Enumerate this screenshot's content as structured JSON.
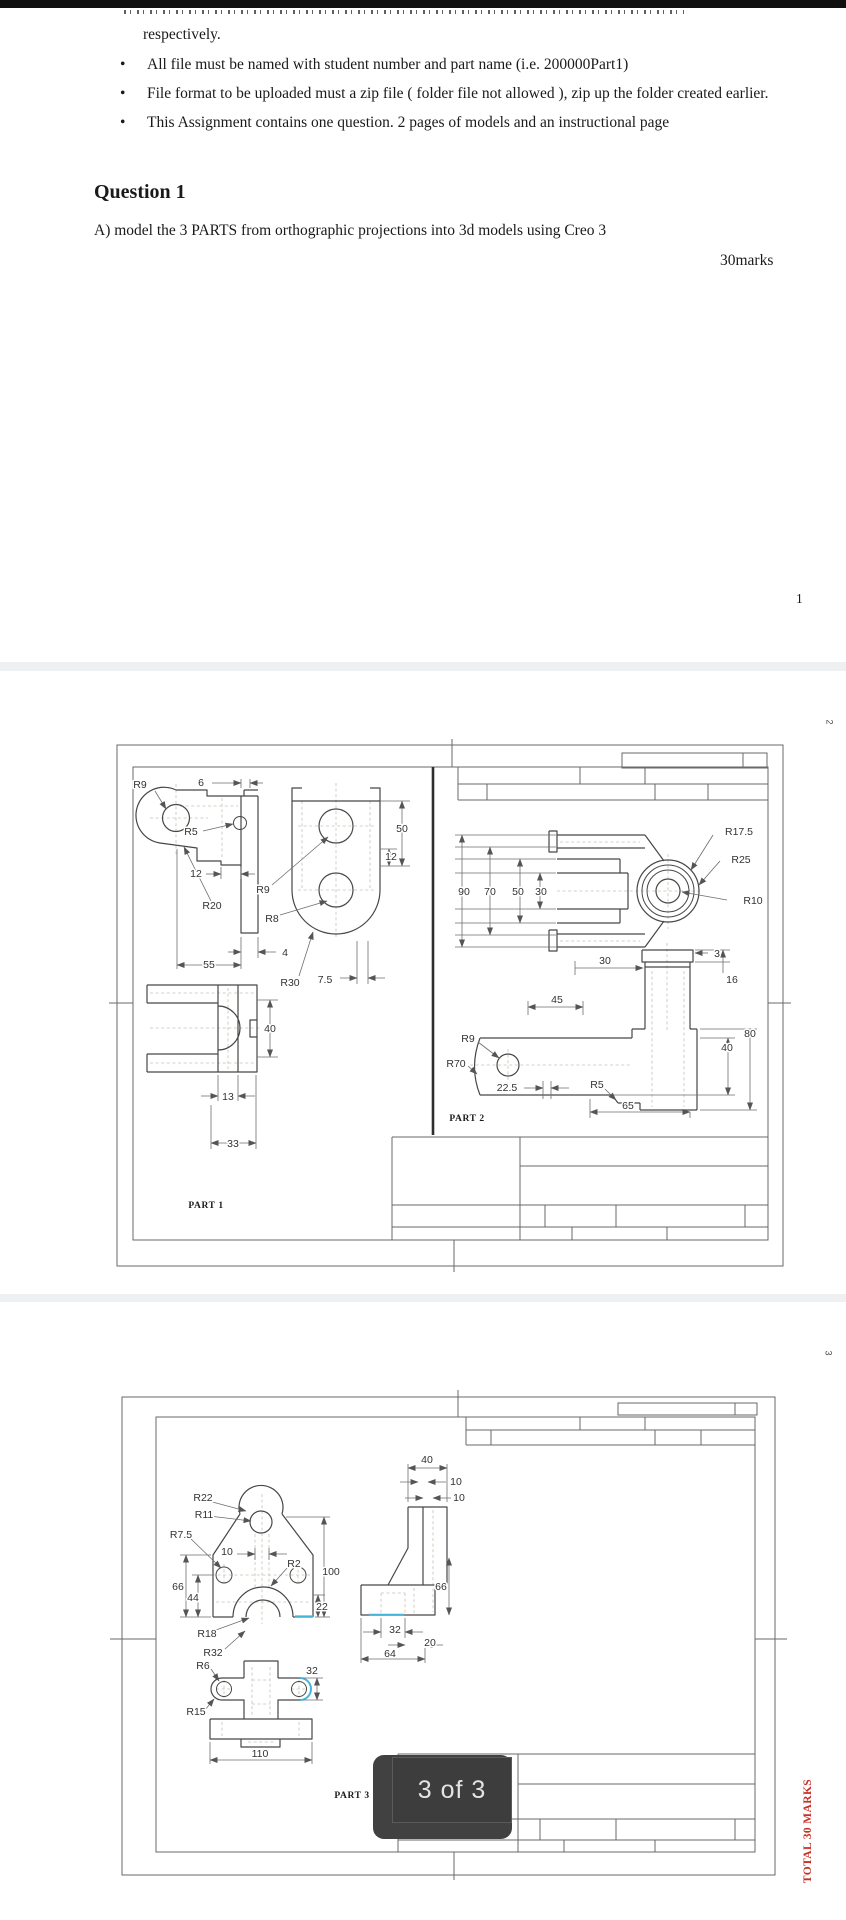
{
  "page1": {
    "intro_tail": "respectively.",
    "bullet_char": "•",
    "bullets": [
      "All file must be named with student number and part name (i.e. 200000Part1)",
      "File format to be uploaded must a zip file ( folder file not allowed ), zip up the folder created earlier.",
      "This Assignment contains one question. 2 pages of models and an instructional page"
    ],
    "question_title": "Question 1",
    "question_body": "A) model the 3 PARTS from orthographic projections into 3d models using Creo 3",
    "marks_note": "30marks",
    "page_number": "1"
  },
  "page2": {
    "page_marker": "2",
    "part1": {
      "label": "PART 1",
      "dims": {
        "r9": "R9",
        "w6": "6",
        "r5": "R5",
        "w12": "12",
        "r20": "R20",
        "w55": "55",
        "w4": "4",
        "r9b": "R9",
        "r8": "R8",
        "r30": "R30",
        "w75": "7.5",
        "h50": "50",
        "h12": "12",
        "h40": "40",
        "w13": "13",
        "w33": "33"
      }
    },
    "part2": {
      "label": "PART 2",
      "dims": {
        "h90": "90",
        "h70": "70",
        "h50": "50",
        "h30": "30",
        "r175": "R17.5",
        "r25": "R25",
        "r10": "R10",
        "w30": "30",
        "w3": "3",
        "h16": "16",
        "w45": "45",
        "r9": "R9",
        "r70": "R70",
        "w225": "22.5",
        "r5": "R5",
        "w65": "65",
        "h40": "40",
        "h80": "80"
      }
    }
  },
  "page3": {
    "page_marker": "3",
    "part3": {
      "label": "PART 3",
      "dims": {
        "r22": "R22",
        "r11": "R11",
        "r75": "R7.5",
        "w10": "10",
        "r2": "R2",
        "h100": "100",
        "h66": "66",
        "h44": "44",
        "h22": "22",
        "r18": "R18",
        "r32": "R32",
        "r6": "R6",
        "r15": "R15",
        "h32": "32",
        "w110": "110",
        "w40": "40",
        "w10a": "10",
        "w10b": "10",
        "h66b": "66",
        "w32": "32",
        "w20": "20",
        "w64": "64"
      }
    },
    "page_indicator": "3 of 3",
    "total_marks": "TOTAL 30 MARKS"
  },
  "colors": {
    "accent_cyan": "#45b6d9",
    "marks_red": "#c63026",
    "toast_bg": "#414141",
    "toast_text": "#e4e4e4"
  }
}
